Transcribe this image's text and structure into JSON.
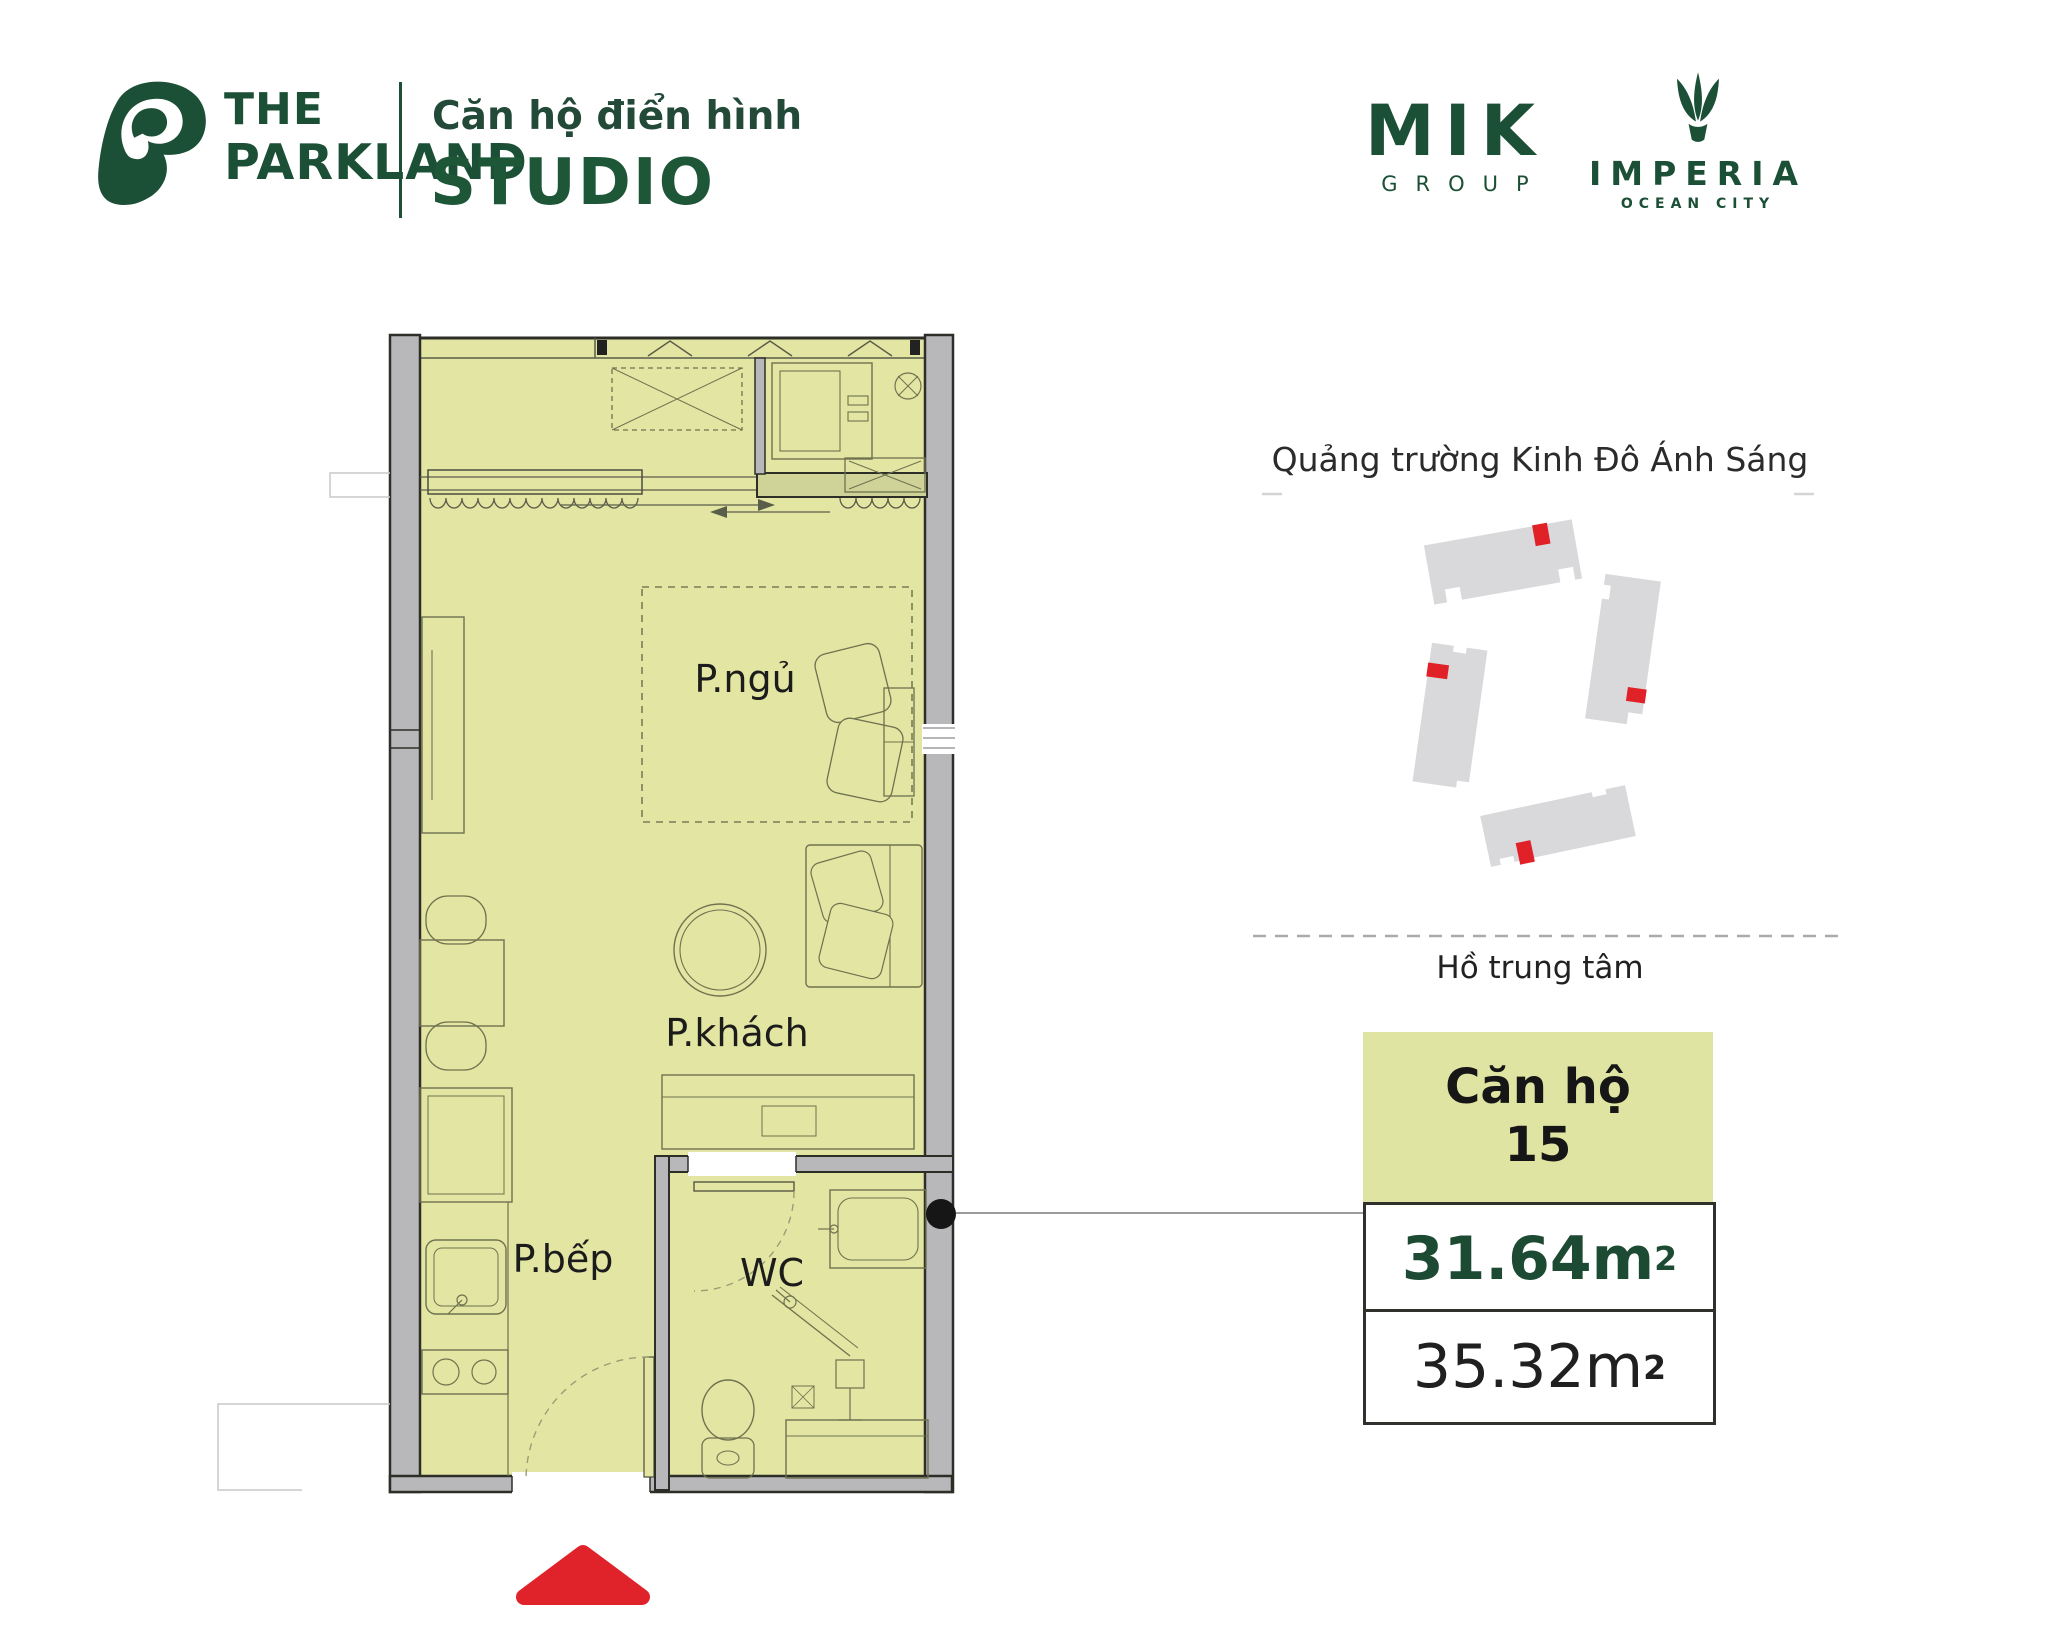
{
  "header": {
    "brand_line1": "THE",
    "brand_line2": "PARKLAND",
    "subtitle": "Căn hộ điển hình",
    "unit_type": "STUDIO"
  },
  "logos": {
    "mik": {
      "name": "MIK",
      "sub": "GROUP"
    },
    "imperia": {
      "name": "IMPERIA",
      "sub": "OCEAN CITY"
    }
  },
  "floor_plan": {
    "rooms": {
      "bedroom": "P.ngủ",
      "living": "P.khách",
      "kitchen": "P.bếp",
      "wc": "WC"
    }
  },
  "site_map": {
    "top_label": "Quảng trường Kinh Đô Ánh Sáng",
    "bottom_label": "Hồ trung tâm"
  },
  "card": {
    "title_line1": "Căn hộ",
    "title_line2": "15",
    "net_area": {
      "value": "31.64",
      "unit": "m",
      "sup": "2"
    },
    "gross_area": {
      "value": "35.32",
      "unit": "m",
      "sup": "2"
    }
  },
  "colors": {
    "brand_green": "#1b4f36",
    "area_green": "#1d4a33",
    "plan_fill": "#e3e6a2",
    "card_head_fill": "#e0e4a2",
    "wall_gray": "#b8b8ba",
    "building_gray": "#d9d9db",
    "marker_red": "#e02127",
    "triangle_red": "#e0232a"
  }
}
